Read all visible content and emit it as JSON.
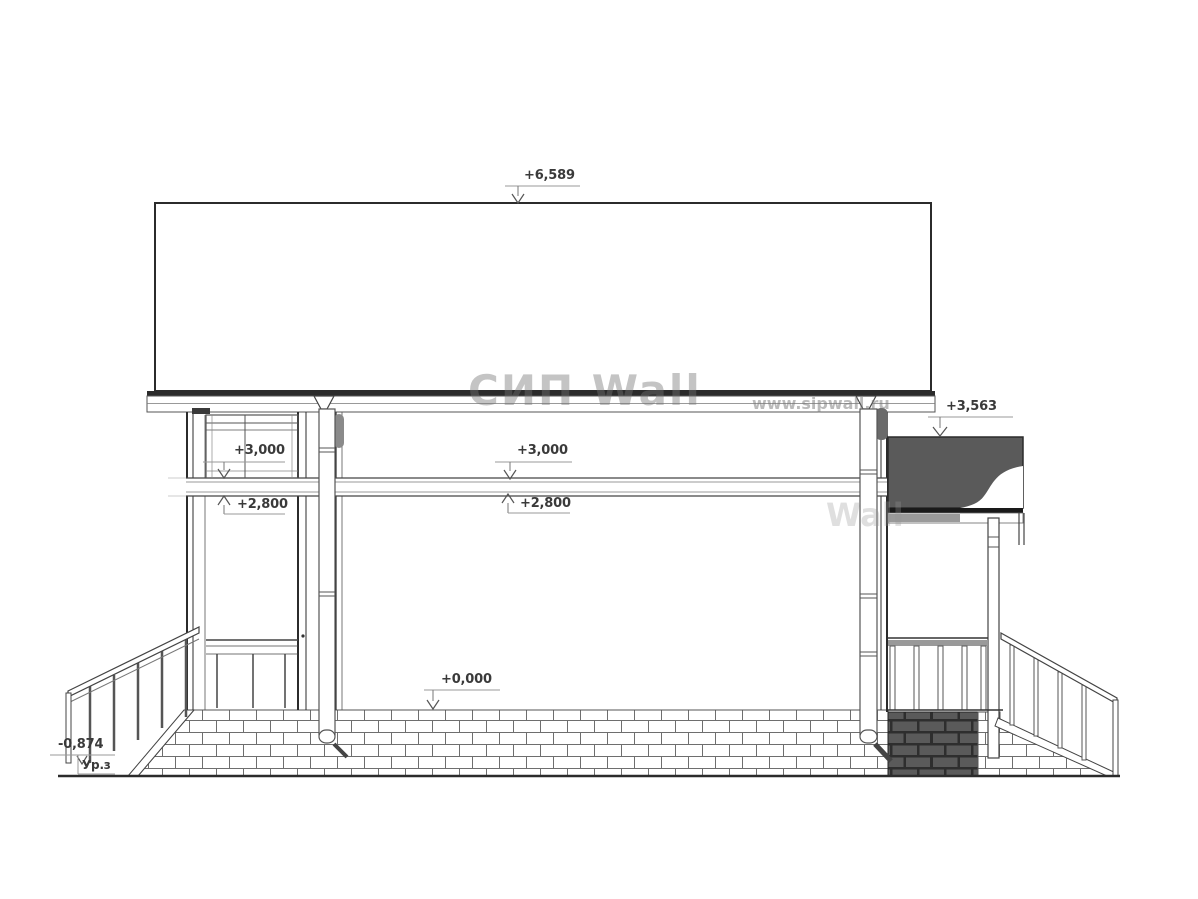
{
  "drawing": {
    "type": "house-side-elevation",
    "labels": {
      "ridge": "+6,589",
      "left_upper": "+3,000",
      "left_lower": "+2,800",
      "center_upper": "+3,000",
      "center_lower": "+2,800",
      "porch_roof": "+3,563",
      "zero": "+0,000",
      "ground": "-0,874",
      "ground_level": "Ур.з"
    },
    "watermark": {
      "logo": "СИП Wall",
      "url": "www.sipwall.ru",
      "fragment": "Wall"
    },
    "colors": {
      "line": "#2b2b2b",
      "leader": "#999999",
      "arrow": "#555555",
      "dark_fill": "#5a5a5a",
      "dark_brick_bg": "#2e2e2e",
      "dark_brick": "#5a5a5a",
      "text": "#3a3a3a",
      "background": "#ffffff"
    }
  }
}
